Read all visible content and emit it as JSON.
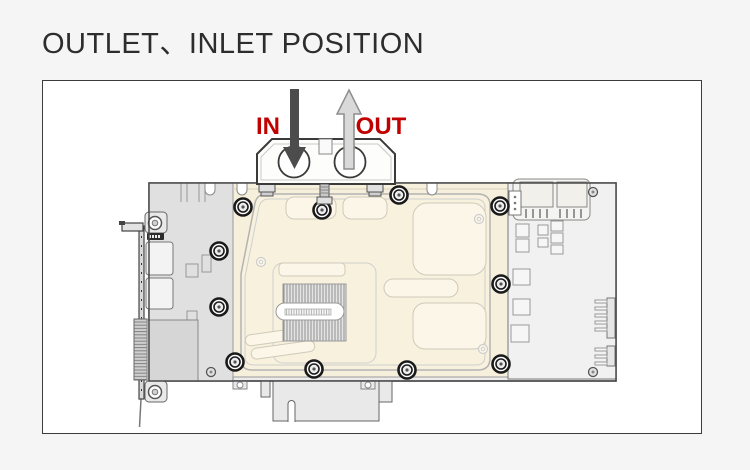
{
  "page": {
    "background_color": "#f5f5f5"
  },
  "header": {
    "title": "OUTLET、INLET POSITION",
    "title_color": "#2d2d2d"
  },
  "diagram": {
    "labels": {
      "in": "IN",
      "out": "OUT"
    },
    "label_color": "#c10000",
    "in_arrow_color": "#4c4c4c",
    "out_arrow_fill": "#d9d9d9",
    "out_arrow_stroke": "#8e8e8e",
    "waterblock_color": "#f6efdb"
  }
}
